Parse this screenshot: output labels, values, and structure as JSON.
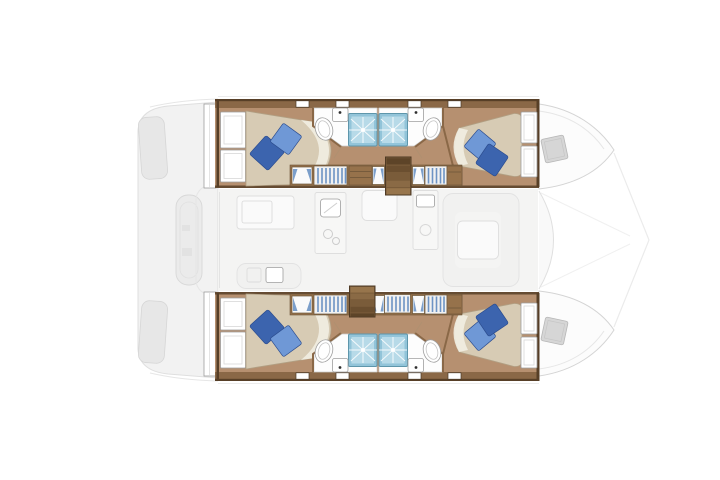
{
  "canvas": {
    "width": 720,
    "height": 480
  },
  "plan": {
    "vessel_type": "catamaran",
    "view": "top-down interior floor plan",
    "bow_direction": "right",
    "stern_direction": "left",
    "hulls": 2,
    "cabins": 4,
    "double_berths": 4,
    "pillows_per_berth": 2,
    "heads": 4,
    "showers": 4,
    "washbasins": 4,
    "toilets": 4,
    "companionway_stairs": 2,
    "bow_deck_hatches": 2,
    "features": [
      "aft-cockpit-deck",
      "engine-hatches",
      "tender-platform",
      "port-hull",
      "starboard-hull",
      "port-aft-cabin",
      "port-forward-cabin",
      "starboard-aft-cabin",
      "starboard-forward-cabin",
      "saloon",
      "galley-counters",
      "galley-sink",
      "stove",
      "forward-lounge",
      "saloon-table",
      "wardrobes",
      "hull-windows",
      "bow-decks",
      "trampoline-lines"
    ]
  },
  "colors": {
    "bg": "#ffffff",
    "deckFill": "#f2f2f2",
    "deckDetail": "#e7e7e7",
    "deckStroke": "#dfdfdf",
    "wallWood": "#8a6847",
    "wallDark": "#573f27",
    "floorWood": "#b69070",
    "furnWood": "#96724b",
    "furnEdge": "#6b5437",
    "stairDark": "#5d4428",
    "stairMid": "#7a5c3a",
    "stairLight": "#97754c",
    "bedLinen": "#d7cbb4",
    "bedEdge": "#b1a084",
    "sheetWhite": "#f2eee2",
    "pillowLight": "#6f98d6",
    "pillowDark": "#3c64ae",
    "pillowEdge": "#2c4d8f",
    "showerBlue": "#92c4d9",
    "showerLight": "#cbe7f0",
    "showerFrame": "#5e96ab",
    "bathFloor": "#fdfdfd",
    "fixtureStroke": "#9e9e9e",
    "white": "#ffffff",
    "winFrame": "#4a3a28",
    "curtainBlue": "#6d93c4",
    "saloonFill": "#f4f4f3",
    "saloonStroke": "#dedede",
    "hatchGray": "#d6d6d6",
    "hatchEdge": "#b7b7b7"
  }
}
